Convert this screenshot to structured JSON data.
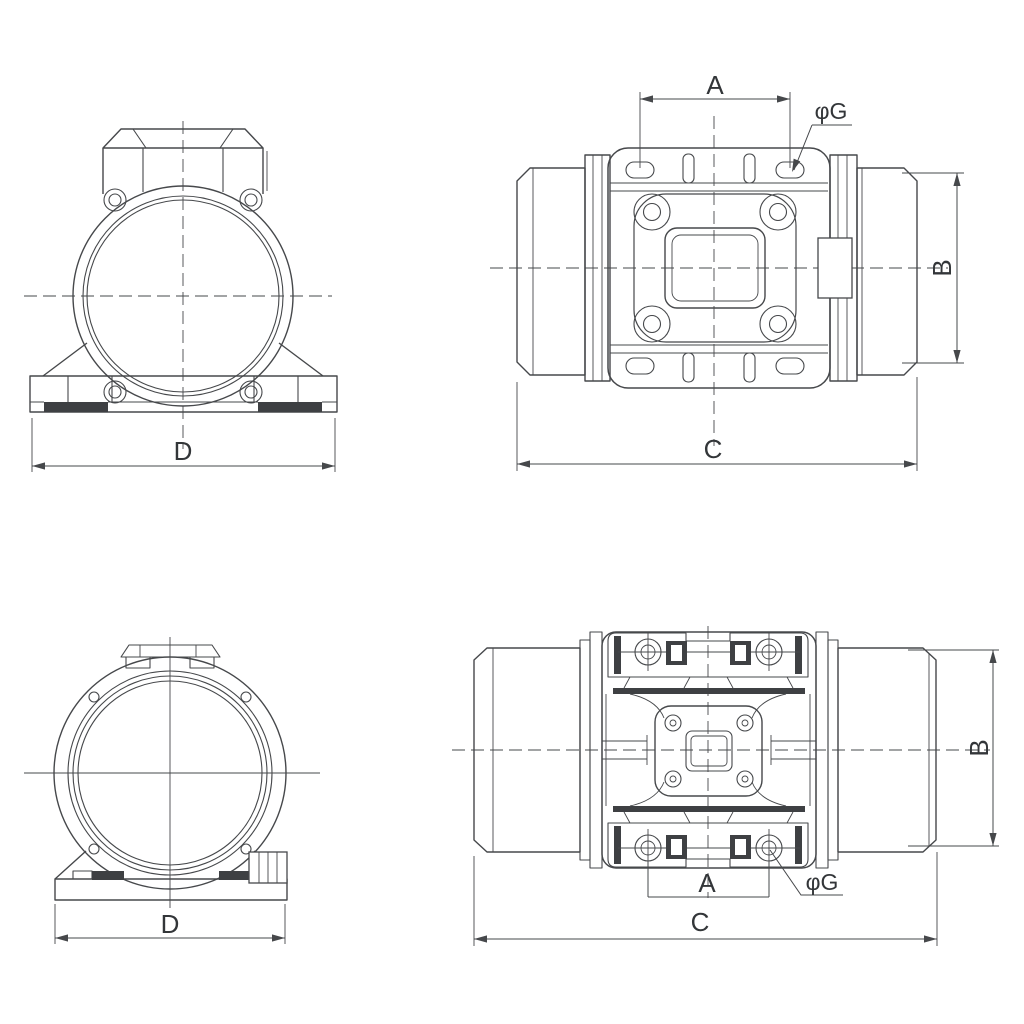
{
  "colors": {
    "background": "#ffffff",
    "line": "#46484b",
    "text": "#333639"
  },
  "views": {
    "top_left": {
      "dim_d": "D"
    },
    "top_right": {
      "dim_a": "A",
      "dim_b": "B",
      "dim_c": "C",
      "dim_g": "φG"
    },
    "bottom_left": {
      "dim_d": "D"
    },
    "bottom_right": {
      "dim_a": "A",
      "dim_b": "B",
      "dim_c": "C",
      "dim_g": "φG"
    }
  }
}
